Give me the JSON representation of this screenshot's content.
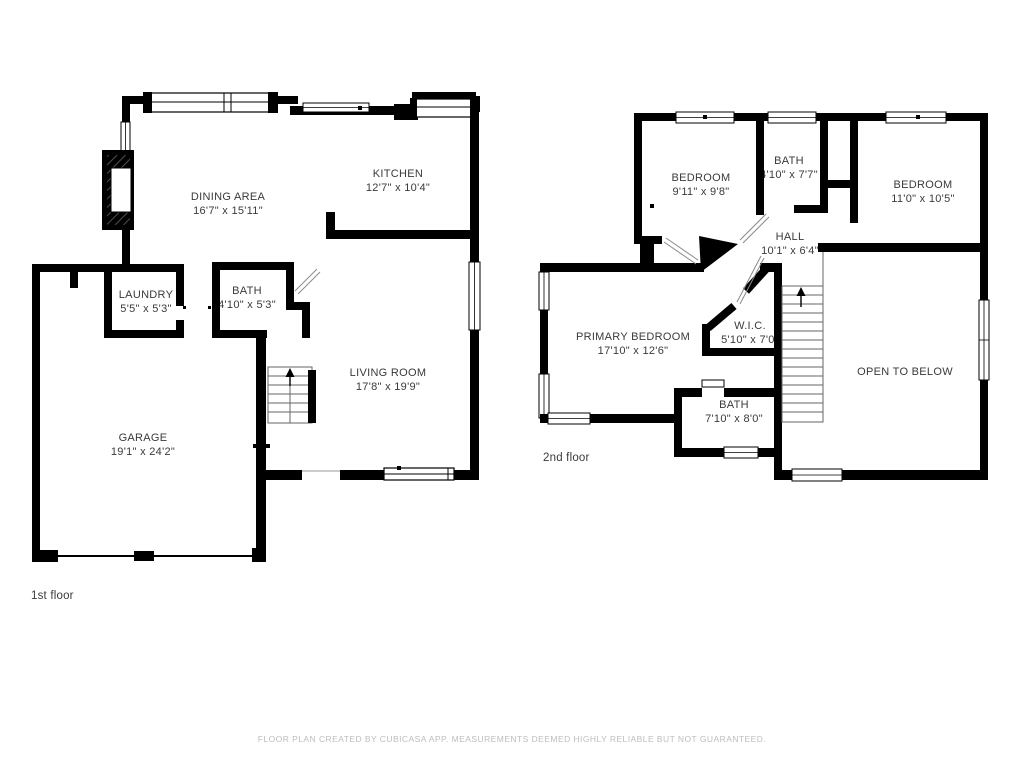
{
  "document": {
    "type": "floor-plan",
    "creator_note": "FLOOR PLAN CREATED BY CUBICASA APP. MEASUREMENTS DEEMED HIGHLY RELIABLE BUT NOT GUARANTEED."
  },
  "colors": {
    "wall": "#000000",
    "background": "#ffffff",
    "label_text": "#3a3a3a",
    "muted_text": "#bdbdbd",
    "thin_line": "#8a8a8a"
  },
  "floors": [
    {
      "label": "1st floor",
      "rooms": [
        {
          "name": "DINING AREA",
          "dims": "16'7\" x 15'11\""
        },
        {
          "name": "KITCHEN",
          "dims": "12'7\" x 10'4\""
        },
        {
          "name": "LAUNDRY",
          "dims": "5'5\" x 5'3\""
        },
        {
          "name": "BATH",
          "dims": "4'10\" x 5'3\""
        },
        {
          "name": "LIVING ROOM",
          "dims": "17'8\" x 19'9\""
        },
        {
          "name": "GARAGE",
          "dims": "19'1\" x 24'2\""
        }
      ]
    },
    {
      "label": "2nd floor",
      "rooms": [
        {
          "name": "BEDROOM",
          "dims": "9'11\" x 9'8\""
        },
        {
          "name": "BATH",
          "dims": "4'10\" x 7'7\""
        },
        {
          "name": "BEDROOM",
          "dims": "11'0\" x 10'5\""
        },
        {
          "name": "HALL",
          "dims": "10'1\" x 6'4\""
        },
        {
          "name": "PRIMARY BEDROOM",
          "dims": "17'10\" x 12'6\""
        },
        {
          "name": "W.I.C.",
          "dims": "5'10\" x 7'0\""
        },
        {
          "name": "BATH",
          "dims": "7'10\" x 8'0\""
        },
        {
          "name": "OPEN TO BELOW",
          "dims": ""
        }
      ]
    }
  ],
  "footer": {
    "disclaimer": "FLOOR PLAN CREATED BY CUBICASA APP. MEASUREMENTS DEEMED HIGHLY RELIABLE BUT NOT GUARANTEED."
  }
}
